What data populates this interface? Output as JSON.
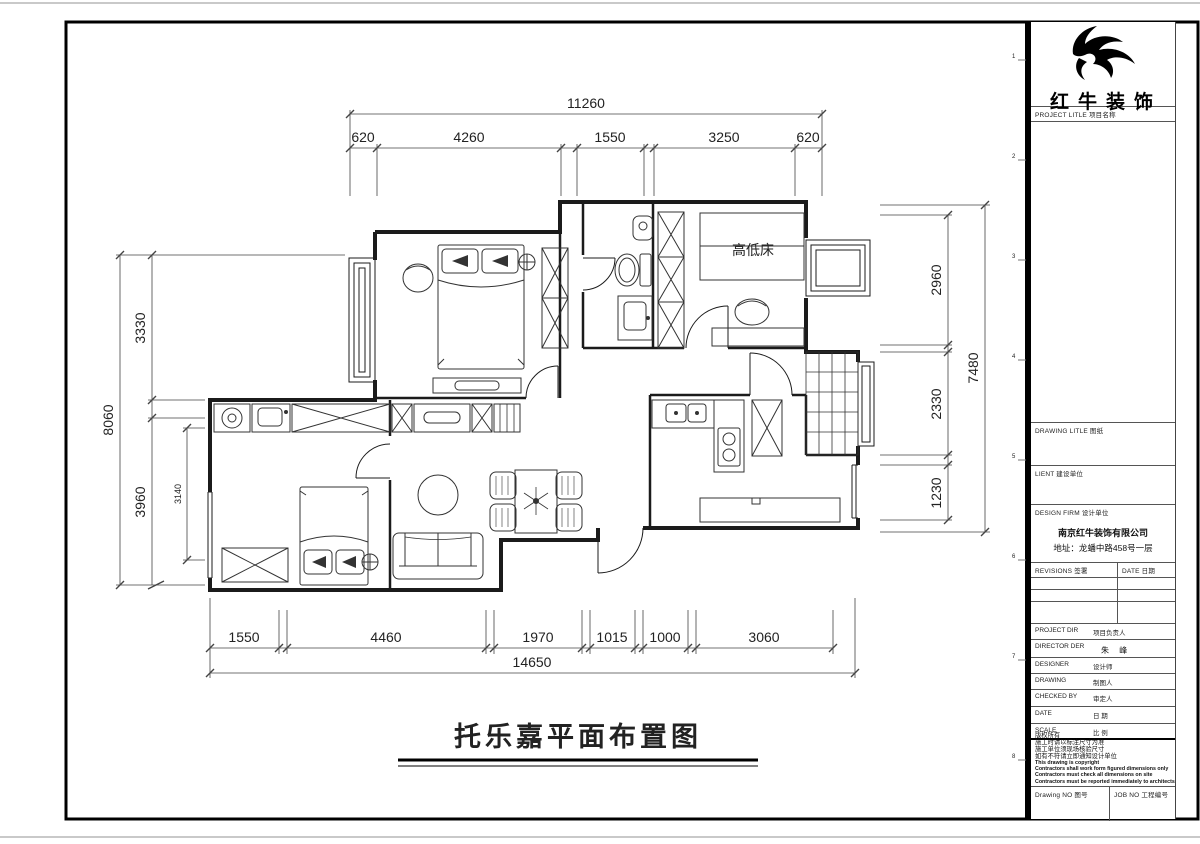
{
  "sheet": {
    "plan_title": "托乐嘉平面布置图",
    "rooms": {
      "bunk_bed_label": "高低床"
    },
    "zone_ticks": [
      "1",
      "2",
      "3",
      "4",
      "5",
      "6",
      "7",
      "8"
    ]
  },
  "dims": {
    "top": {
      "overall": "11260",
      "segs": [
        "620",
        "4260",
        "1550",
        "3250",
        "620"
      ]
    },
    "bottom": {
      "overall": "14650",
      "segs": [
        "1550",
        "4460",
        "1970",
        "1015",
        "1000",
        "3060"
      ]
    },
    "left": {
      "overall": "8060",
      "segs": [
        "3330",
        "3960"
      ],
      "inner": "3140"
    },
    "right": {
      "overall": "7480",
      "segs": [
        "2960",
        "2330",
        "1230"
      ]
    }
  },
  "title_block": {
    "brand": "红牛装饰",
    "project_label": "PROJECT LITLE  项目名称",
    "drawing_label": "DRAWING LITLE  图纸",
    "client_label": "LIENT  建设单位",
    "firm_label": "DESIGN FIRM  设计单位",
    "firm_name": "南京红牛装饰有限公司",
    "firm_address": "地址：龙蟠中路458号一层",
    "revisions_label": "REVISIONS  签署",
    "date_col_label": "DATE  日期",
    "rows": [
      {
        "en": "PROJECT DIR",
        "cn": "项目负责人",
        "val": ""
      },
      {
        "en": "DIRECTOR DER",
        "cn": "",
        "val": "朱 峰"
      },
      {
        "en": "DESIGNER",
        "cn": "设计师",
        "val": ""
      },
      {
        "en": "DRAWING",
        "cn": "制图人",
        "val": ""
      },
      {
        "en": "CHECKED BY",
        "cn": "审定人",
        "val": ""
      },
      {
        "en": "DATE",
        "cn": "日 期",
        "val": ""
      },
      {
        "en": "SCALE",
        "cn": "比 例",
        "val": ""
      }
    ],
    "copyright_cn": [
      "版权所有",
      "施工时请以标注尺寸为准",
      "施工单位须现场核验尺寸",
      "如有不符请立即通知设计单位"
    ],
    "copyright_en": [
      "This drawing is copyright",
      "Contractors shall work form figured dimensions only",
      "Contractors must check all dimensions on site",
      "Contractors must be reported immediately to architects"
    ],
    "drawing_no_label": "Drawing NO  图号",
    "job_no_label": "JOB NO  工程编号"
  }
}
